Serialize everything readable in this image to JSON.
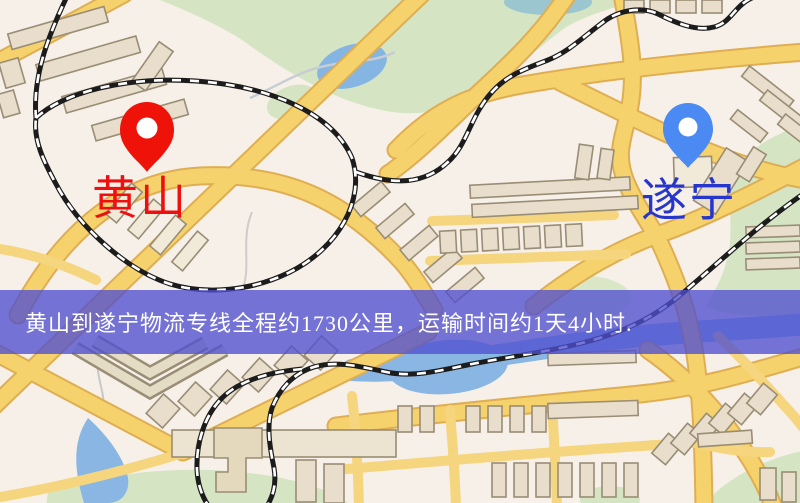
{
  "map": {
    "markers": {
      "origin": {
        "label": "黄山"
      },
      "destination": {
        "label": "遂宁"
      }
    },
    "banner": {
      "text": "黄山到遂宁物流专线全程约1730公里，运输时间约1天4小时."
    },
    "palette": {
      "background": "#f7f0e9",
      "road": "#f5d26c",
      "road_casing": "#dfae52",
      "building": "#e8decb",
      "building_outline": "#998d75",
      "park": "#d5e5c3",
      "water": "#8ab6e4",
      "pond_teal": "#9cc6cf",
      "railway": "#1c1c1c",
      "banner_bg": "#4f4fd0",
      "banner_text": "#ffffff",
      "origin_pin": "#ee1208",
      "origin_label": "#ee0f0f",
      "destination_pin": "#4a8af2",
      "destination_label": "#2636cc"
    }
  }
}
